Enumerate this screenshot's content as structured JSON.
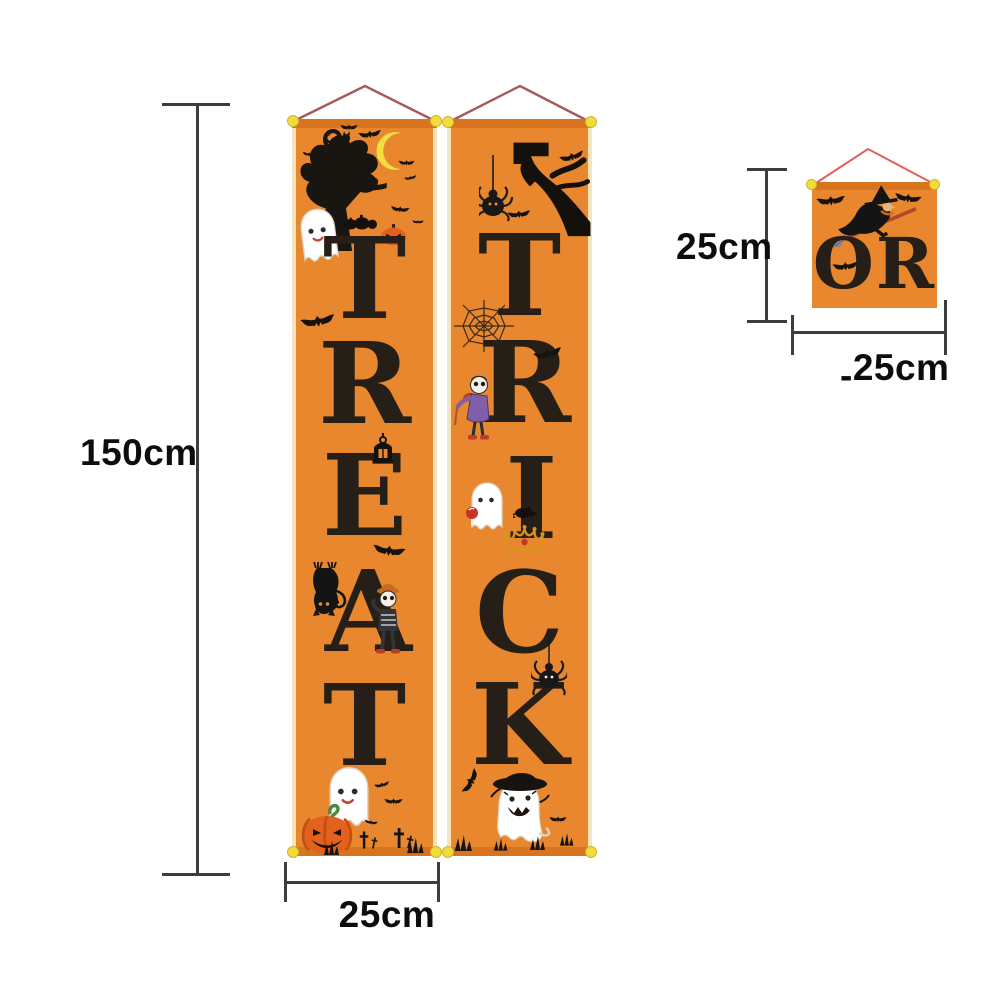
{
  "banners": {
    "left": {
      "word": "TREAT",
      "letters": [
        "T",
        "R",
        "E",
        "A",
        "T"
      ]
    },
    "right": {
      "word": "TRICK",
      "letters": [
        "T",
        "R",
        "I",
        "C",
        "K"
      ]
    },
    "small": {
      "word": "OR"
    }
  },
  "dimensions": {
    "height_label": "150cm",
    "width_label": "25cm",
    "small_height_label": "25cm",
    "small_width_label": "25cm",
    "small_width_stray_mark": "-"
  },
  "colors": {
    "banner_orange": "#E8872E",
    "rod_orange": "#D8731E",
    "fabric_edge_cream": "#F6E4BD",
    "letter_black": "#261F18",
    "string_red": "#A85A5A",
    "small_string_red": "#E06060",
    "pin_yellow": "#F2DC3C",
    "moon_yellow": "#F2DF3D",
    "pumpkin_orange": "#E2611C",
    "stem_green": "#4C8A3A",
    "crown_gold": "#D9941F",
    "coat_purple": "#7E5FA8",
    "candy_red": "#C63327",
    "dimension_line_gray": "#3D3D3D",
    "background_white": "#FFFFFF"
  },
  "icons": {
    "bat": "black bat silhouette",
    "ghost": "white cartoon ghost",
    "spooky-tree": "bare black tree with cats",
    "crescent-moon": "yellow crescent moon",
    "jack-o-lantern": "orange carved pumpkin",
    "lantern": "hanging black lantern",
    "spider": "black spider on thread",
    "spider-web": "spider web",
    "creepy-branch": "black gnarled branch",
    "hanging-cat": "black cat hanging upside down",
    "skeleton": "cartoon skeleton figure",
    "witch-on-broom": "witch flying on broomstick",
    "crown": "gold crown",
    "cross": "grave cross",
    "grass": "black grass tuft",
    "witch-hat-ghost": "ghost wearing witch hat",
    "rat": "black rat silhouette"
  }
}
